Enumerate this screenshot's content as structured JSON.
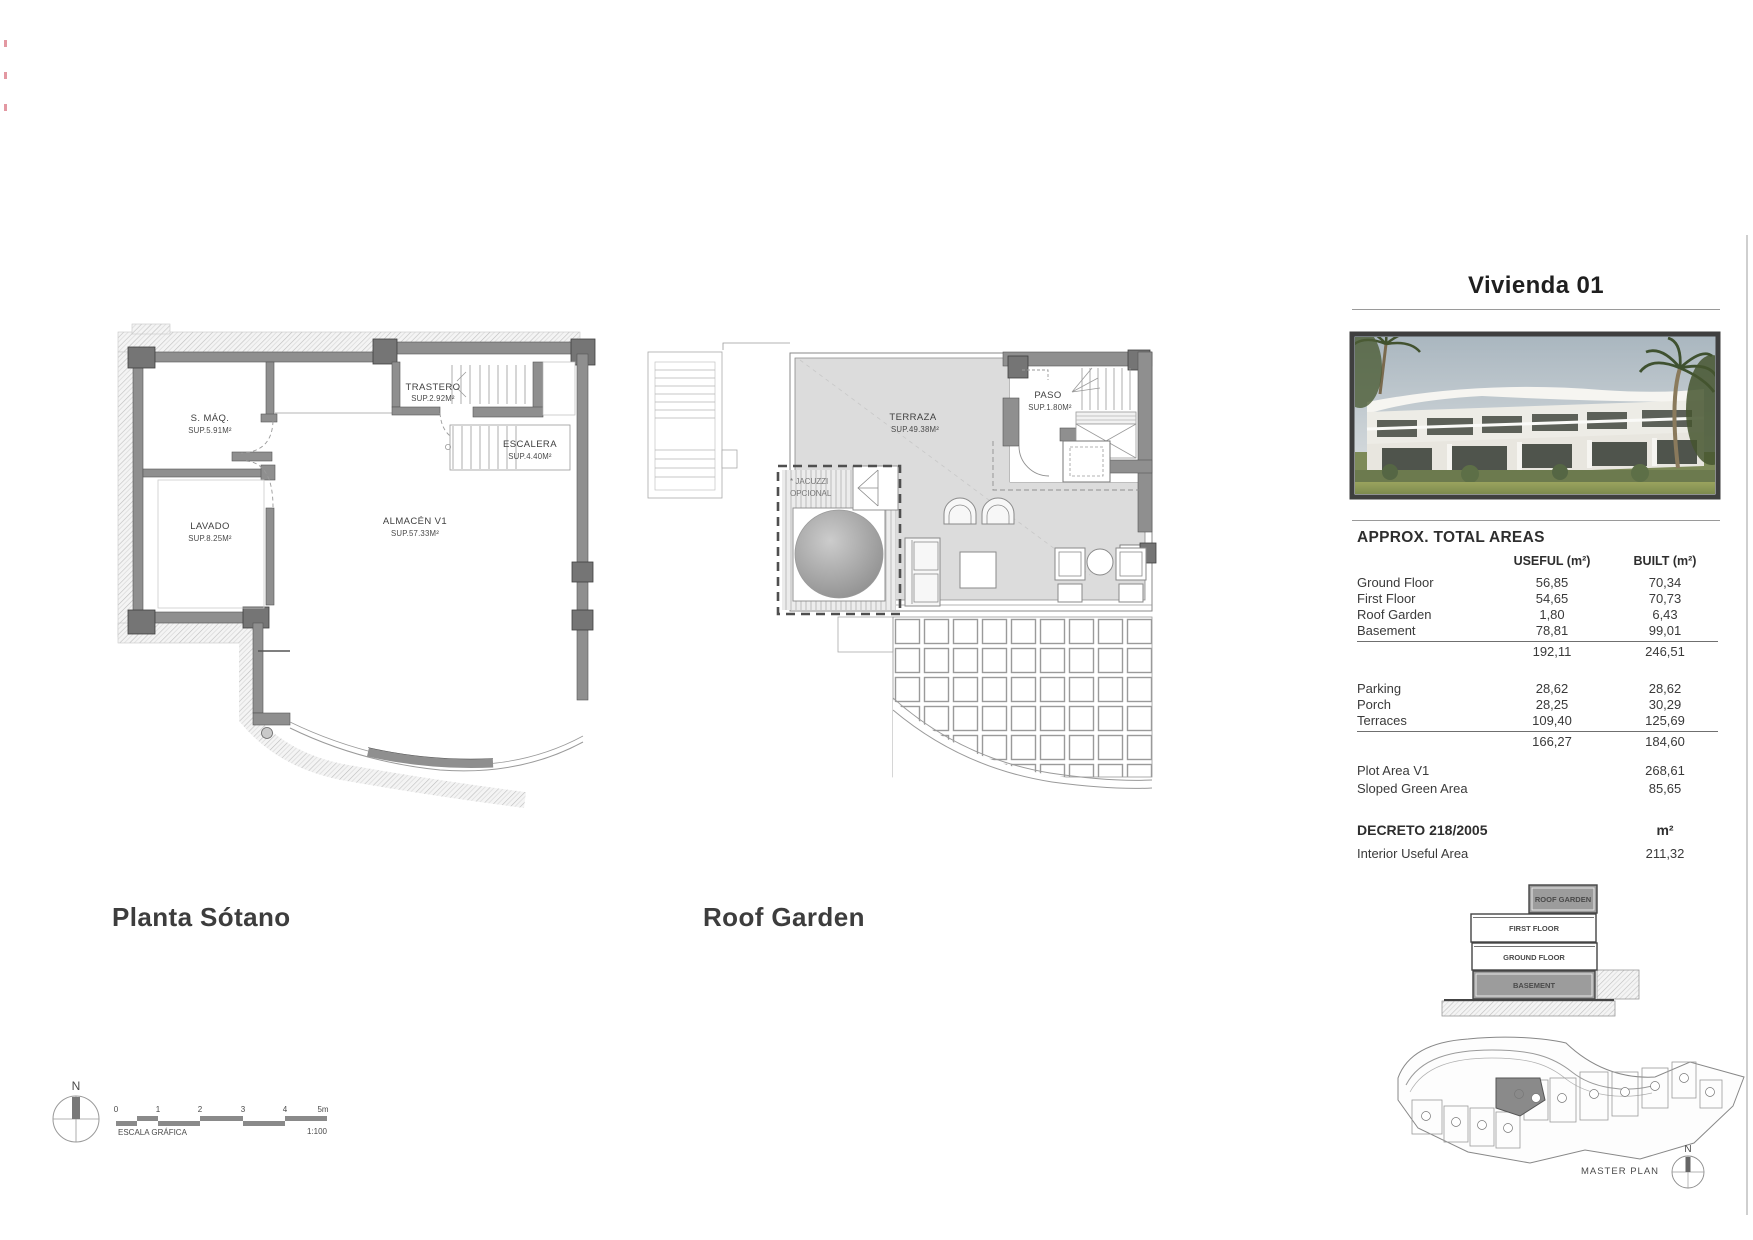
{
  "plans": {
    "basement": {
      "title": "Planta Sótano",
      "rooms": {
        "smaq": {
          "name": "S. MÁQ.",
          "area": "SUP.5.91M²"
        },
        "lavado": {
          "name": "LAVADO",
          "area": "SUP.8.25M²"
        },
        "trastero": {
          "name": "TRASTERO",
          "area": "SUP.2.92M²"
        },
        "escalera": {
          "name": "ESCALERA",
          "area": "SUP.4.40M²"
        },
        "almacen": {
          "name": "ALMACÉN V1",
          "area": "SUP.57.33M²"
        }
      }
    },
    "roof": {
      "title": "Roof Garden",
      "rooms": {
        "terraza": {
          "name": "TERRAZA",
          "area": "SUP.49.38M²"
        },
        "paso": {
          "name": "PASO",
          "area": "SUP.1.80M²"
        },
        "jacuzzi_line1": "* JACUZZI",
        "jacuzzi_line2": "OPCIONAL"
      }
    }
  },
  "scalebar": {
    "north": "N",
    "ticks": [
      "0",
      "1",
      "2",
      "3",
      "4",
      "5m"
    ],
    "label": "ESCALA GRÁFICA",
    "ratio": "1:100"
  },
  "panel": {
    "title": "Vivienda 01",
    "areas_heading": "APPROX. TOTAL AREAS",
    "col_useful": "USEFUL (m²)",
    "col_built": "BUILT (m²)",
    "rows_floors": [
      {
        "label": "Ground Floor",
        "useful": "56,85",
        "built": "70,34"
      },
      {
        "label": "First Floor",
        "useful": "54,65",
        "built": "70,73"
      },
      {
        "label": "Roof Garden",
        "useful": "1,80",
        "built": "6,43"
      },
      {
        "label": "Basement",
        "useful": "78,81",
        "built": "99,01"
      }
    ],
    "total_floors": {
      "useful": "192,11",
      "built": "246,51"
    },
    "rows_exterior": [
      {
        "label": "Parking",
        "useful": "28,62",
        "built": "28,62"
      },
      {
        "label": "Porch",
        "useful": "28,25",
        "built": "30,29"
      },
      {
        "label": "Terraces",
        "useful": "109,40",
        "built": "125,69"
      }
    ],
    "total_exterior": {
      "useful": "166,27",
      "built": "184,60"
    },
    "rows_plot": [
      {
        "label": "Plot Area V1",
        "value": "268,61"
      },
      {
        "label": "Sloped Green Area",
        "value": "85,65"
      }
    ],
    "decreto": {
      "label": "DECRETO 218/2005",
      "unit": "m²",
      "row_label": "Interior Useful Area",
      "row_value": "211,32"
    },
    "stack": {
      "roof": "ROOF GARDEN",
      "first": "FIRST FLOOR",
      "ground": "GROUND FLOOR",
      "basement": "BASEMENT"
    },
    "master_plan": {
      "label": "MASTER PLAN",
      "north": "N"
    }
  },
  "colors": {
    "wall_gray": "#8f8f8f",
    "pilaster_gray": "#757575",
    "terrace_fill": "#dcdcdc",
    "stack_highlight": "#9c9c9c",
    "text_dark": "#3d3d3d",
    "sheet_edge": "#cfcfcf"
  }
}
